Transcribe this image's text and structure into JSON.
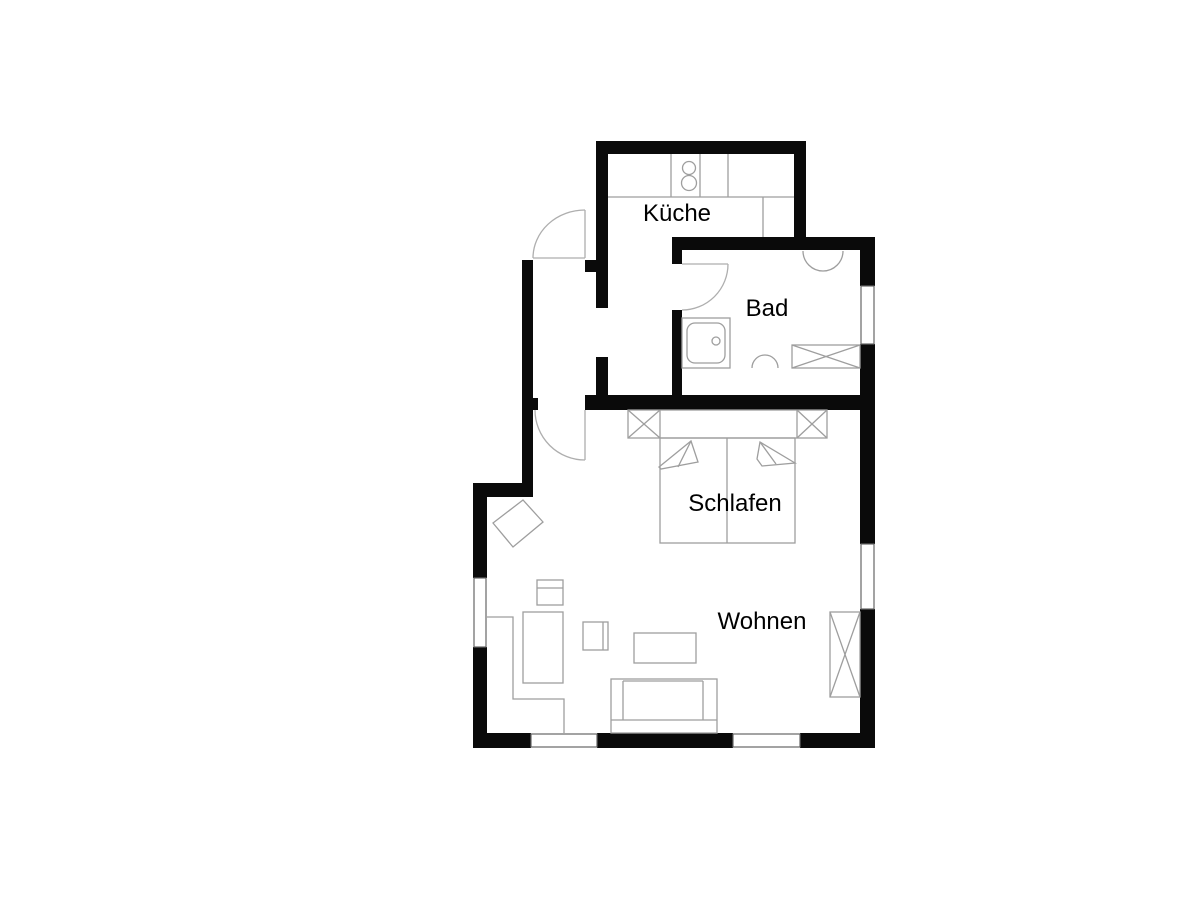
{
  "floorplan": {
    "type": "apartment-floor-plan",
    "language": "de",
    "rooms": [
      {
        "id": "kueche",
        "label": "Küche"
      },
      {
        "id": "bad",
        "label": "Bad"
      },
      {
        "id": "schlafen",
        "label": "Schlafen"
      },
      {
        "id": "wohnen",
        "label": "Wohnen"
      }
    ],
    "fixtures": [
      "stove-two-burners",
      "kitchen-counter",
      "wash-basin",
      "shower",
      "toilet",
      "washer-crossed-box",
      "double-bed-with-pillows",
      "wardrobe-crossed-boxes",
      "sofa",
      "coffee-table",
      "side-table",
      "armchair-rotated",
      "cabinet"
    ],
    "openings": [
      "entry-door",
      "living-room-door",
      "bath-door",
      "kitchen-passage"
    ],
    "windows_count": 5,
    "colors": {
      "wall": "#0a0a0a",
      "furniture_line": "#9e9e9e",
      "door_arc": "#aeaeae",
      "window_line": "#666666",
      "label_text": "#000000",
      "background": "#ffffff"
    }
  }
}
